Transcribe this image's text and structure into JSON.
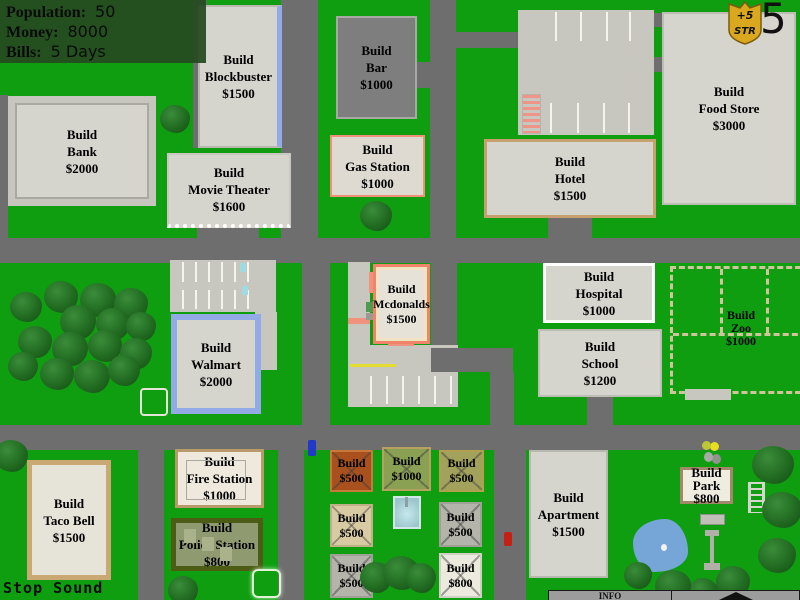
{
  "hud": {
    "population_label": "Population:",
    "population_value": "50",
    "money_label": "Money:",
    "money_value": "8000",
    "bills_label": "Bills:",
    "bills_value": "5 Days"
  },
  "badge": {
    "bonus": "+5",
    "stat": "STR",
    "counter": "5"
  },
  "buildings": {
    "bank": {
      "action": "Build",
      "name": "Bank",
      "price": "$2000"
    },
    "blockbuster": {
      "action": "Build",
      "name": "Blockbuster",
      "price": "$1500"
    },
    "movie_theater": {
      "action": "Build",
      "name": "Movie Theater",
      "price": "$1600"
    },
    "bar": {
      "action": "Build",
      "name": "Bar",
      "price": "$1000"
    },
    "gas_station": {
      "action": "Build",
      "name": "Gas Station",
      "price": "$1000"
    },
    "food_store": {
      "action": "Build",
      "name": "Food Store",
      "price": "$3000"
    },
    "hotel": {
      "action": "Build",
      "name": "Hotel",
      "price": "$1500"
    },
    "mcdonalds": {
      "action": "Build",
      "name": "Mcdonalds",
      "price": "$1500"
    },
    "hospital": {
      "action": "Build",
      "name": "Hospital",
      "price": "$1000"
    },
    "school": {
      "action": "Build",
      "name": "School",
      "price": "$1200"
    },
    "zoo": {
      "action": "Build",
      "name": "Zoo",
      "price": "$1000"
    },
    "walmart": {
      "action": "Build",
      "name": "Walmart",
      "price": "$2000"
    },
    "taco_bell": {
      "action": "Build",
      "name": "Taco Bell",
      "price": "$1500"
    },
    "fire_station": {
      "action": "Build",
      "name": "Fire Station",
      "price": "$1000"
    },
    "police_station": {
      "action": "Build",
      "name": "Police Station",
      "price": "$800"
    },
    "apartment": {
      "action": "Build",
      "name": "Apartment",
      "price": "$1500"
    },
    "park": {
      "action": "Build",
      "name": "Park",
      "price": "$800"
    }
  },
  "lots": {
    "lot1": {
      "action": "Build",
      "price": "$500"
    },
    "lot2": {
      "action": "Build",
      "price": "$1000"
    },
    "lot3": {
      "action": "Build",
      "price": "$500"
    },
    "lot4": {
      "action": "Build",
      "price": "$500"
    },
    "lot5": {
      "action": "Build",
      "price": "$500"
    },
    "lot6": {
      "action": "Build",
      "price": "$500"
    },
    "lot7": {
      "action": "Build",
      "price": "$800"
    }
  },
  "controls": {
    "sound_toggle_label": "Stop Sound",
    "info_tab_label": "INFO",
    "expand_icon": "triangle-up-icon"
  },
  "colors": {
    "grass": "#0e9e10",
    "road": "#6e6e6e",
    "parking": "#c7c7bf",
    "building": "#d5d4cd",
    "hud_bg": "rgba(38,74,32,0.93)",
    "badge_gold": "#d9a81e"
  }
}
